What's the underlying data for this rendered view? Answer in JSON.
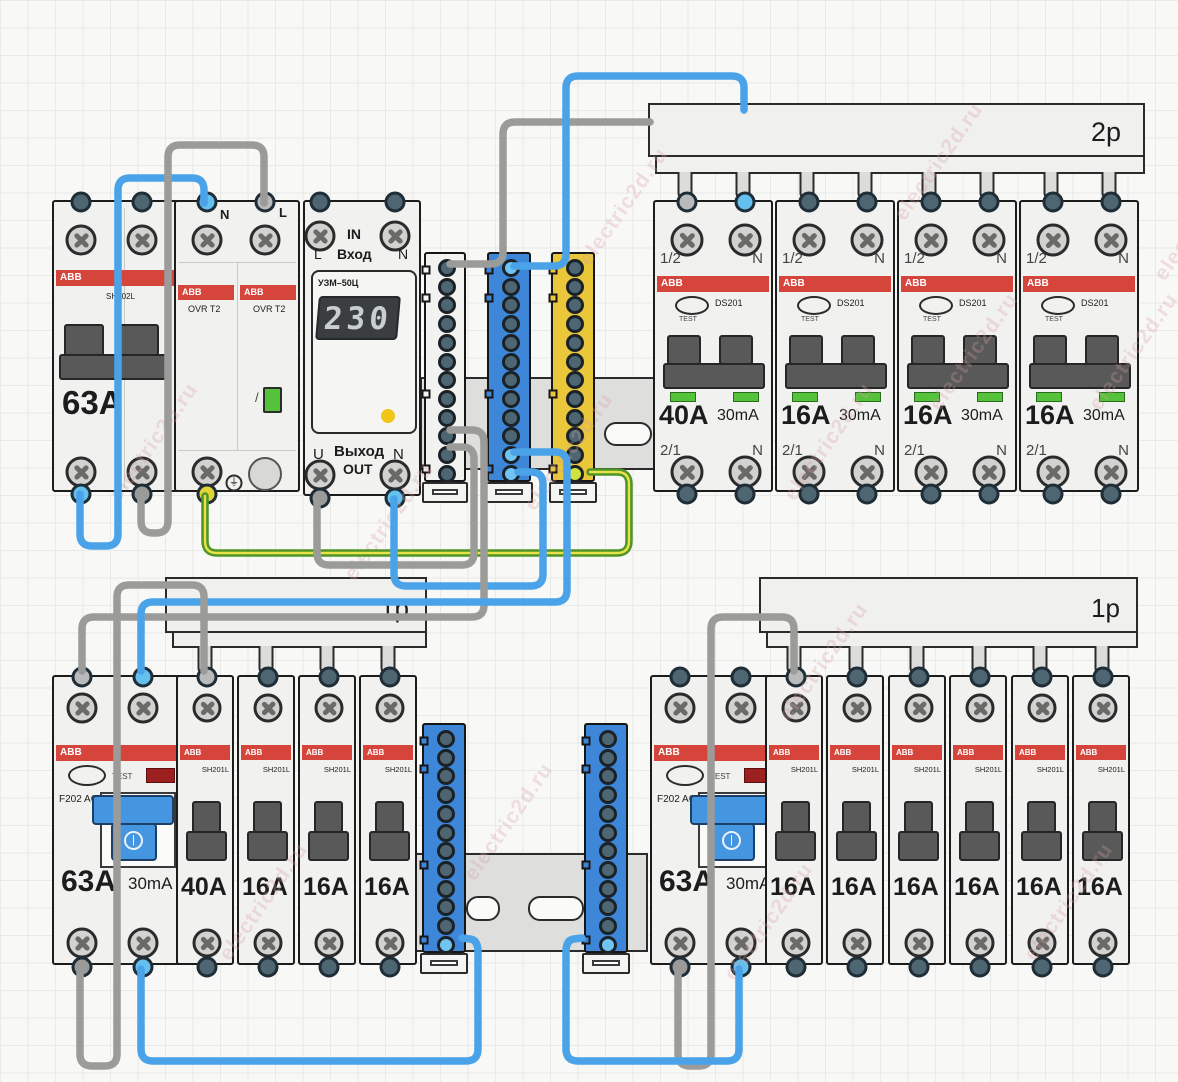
{
  "canvas": {
    "width": 1178,
    "height": 1082,
    "background": "#f8f8f6",
    "grid_color": "#e8eae8"
  },
  "watermark": {
    "text": "electric2d.ru",
    "color": "rgba(216,158,158,0.30)",
    "positions": [
      [
        85,
        430
      ],
      [
        320,
        510
      ],
      [
        500,
        440
      ],
      [
        555,
        195
      ],
      [
        760,
        430
      ],
      [
        905,
        340
      ],
      [
        1065,
        340
      ],
      [
        1130,
        210
      ],
      [
        195,
        890
      ],
      [
        440,
        810
      ],
      [
        700,
        910
      ],
      [
        1000,
        890
      ],
      [
        755,
        650
      ],
      [
        870,
        150
      ]
    ]
  },
  "colors": {
    "wire_blue": "#4aa3e8",
    "wire_gray": "#9b9b99",
    "wire_green": "#4e9426",
    "wire_green_stripe": "#e8e14a",
    "abb_red": "#d6453c",
    "cap_slate": "#4e6672",
    "cap_light_blue": "#63c0ef",
    "cap_light_gray": "#b9babb",
    "cap_gray": "#9a9a98",
    "cap_yellow": "#e3d438",
    "cap_pe_green": "#cfe23e",
    "busbar_blue": "#3e86d8",
    "busbar_yellow": "#e9c63a",
    "busbar_white": "#f2f2f0",
    "indicator_green": "#55c23c",
    "rcd_handle_blue": "#4596e0"
  },
  "top_row": {
    "sh202l": {
      "brand": "ABB",
      "model": "SH202L",
      "rating": "63A"
    },
    "ovr": {
      "n_label": "N",
      "l_label": "L",
      "left": {
        "brand": "ABB",
        "model": "OVR T2"
      },
      "right": {
        "brand": "ABB",
        "model": "OVR T2"
      },
      "earth_symbol": "⏚"
    },
    "uzm": {
      "model": "УЗМ–50Ц",
      "in_word": "IN",
      "in_ru": "Вход",
      "in_l": "L",
      "in_n": "N",
      "display": "230",
      "out_u": "U",
      "out_ru": "Выход",
      "out_word": "OUT",
      "out_n": "N"
    },
    "comb_2p_label": "2p",
    "ds201": [
      {
        "brand": "ABB",
        "model": "DS201",
        "test": "TEST",
        "t1": "1/2",
        "t2": "N",
        "b1": "2/1",
        "b2": "N",
        "rating": "40A",
        "diff": "30mA"
      },
      {
        "brand": "ABB",
        "model": "DS201",
        "test": "TEST",
        "t1": "1/2",
        "t2": "N",
        "b1": "2/1",
        "b2": "N",
        "rating": "16A",
        "diff": "30mA"
      },
      {
        "brand": "ABB",
        "model": "DS201",
        "test": "TEST",
        "t1": "1/2",
        "t2": "N",
        "b1": "2/1",
        "b2": "N",
        "rating": "16A",
        "diff": "30mA"
      },
      {
        "brand": "ABB",
        "model": "DS201",
        "test": "TEST",
        "t1": "1/2",
        "t2": "N",
        "b1": "2/1",
        "b2": "N",
        "rating": "16A",
        "diff": "30mA"
      }
    ]
  },
  "bottom_row": {
    "comb_1p_left_label": "1p",
    "comb_1p_right_label": "1p",
    "rcd_left": {
      "brand": "ABB",
      "model": "F202 AC",
      "test": "TEST",
      "rating": "63A",
      "diff": "30mA"
    },
    "rcd_right": {
      "brand": "ABB",
      "model": "F202 AC",
      "test": "TEST",
      "rating": "63A",
      "diff": "30mA"
    },
    "breakers_left": [
      {
        "brand": "ABB",
        "model": "SH201L",
        "rating": "40A"
      },
      {
        "brand": "ABB",
        "model": "SH201L",
        "rating": "16A"
      },
      {
        "brand": "ABB",
        "model": "SH201L",
        "rating": "16A"
      },
      {
        "brand": "ABB",
        "model": "SH201L",
        "rating": "16A"
      }
    ],
    "breakers_right": [
      {
        "brand": "ABB",
        "model": "SH201L",
        "rating": "16A"
      },
      {
        "brand": "ABB",
        "model": "SH201L",
        "rating": "16A"
      },
      {
        "brand": "ABB",
        "model": "SH201L",
        "rating": "16A"
      },
      {
        "brand": "ABB",
        "model": "SH201L",
        "rating": "16A"
      },
      {
        "brand": "ABB",
        "model": "SH201L",
        "rating": "16A"
      },
      {
        "brand": "ABB",
        "model": "SH201L",
        "rating": "16A"
      }
    ]
  },
  "busbars": {
    "top_white": {
      "kind": "terminal-strip",
      "color": "#f2f2f0",
      "terminals": 12,
      "specials": {}
    },
    "top_blue": {
      "kind": "neutral-busbar",
      "color": "#3e86d8",
      "terminals": 12,
      "specials": {
        "0": "blue",
        "10": "blue",
        "11": "blue"
      }
    },
    "top_yellow": {
      "kind": "pe-busbar",
      "color": "#e9c63a",
      "terminals": 12,
      "specials": {
        "11": "pe"
      }
    },
    "bottom_blue_left": {
      "kind": "neutral-busbar",
      "color": "#3e86d8",
      "terminals": 12,
      "specials": {
        "11": "blue"
      }
    },
    "bottom_blue_right": {
      "kind": "neutral-busbar",
      "color": "#3e86d8",
      "terminals": 12,
      "specials": {
        "11": "blue"
      }
    }
  },
  "wires": [
    {
      "name": "wire-n-sh202l-to-ovr",
      "color": "#4aa3e8",
      "points": [
        [
          80,
          494
        ],
        [
          80,
          546
        ],
        [
          118,
          546
        ],
        [
          118,
          178
        ],
        [
          204,
          178
        ],
        [
          204,
          203
        ]
      ]
    },
    {
      "name": "wire-l-sh202l-to-ovr",
      "color": "#9b9b99",
      "points": [
        [
          141,
          494
        ],
        [
          141,
          533
        ],
        [
          168,
          533
        ],
        [
          168,
          145
        ],
        [
          264,
          145
        ],
        [
          264,
          203
        ]
      ]
    },
    {
      "name": "wire-pe-ovr-to-yellow-busbar",
      "color": "#4e9426",
      "stripe": "#e8e14a",
      "points": [
        [
          205,
          496
        ],
        [
          205,
          553
        ],
        [
          629,
          553
        ],
        [
          629,
          472
        ],
        [
          590,
          472
        ]
      ]
    },
    {
      "name": "wire-l-uzm-to-white-strip",
      "color": "#9b9b99",
      "points": [
        [
          317,
          499
        ],
        [
          317,
          565
        ],
        [
          474,
          565
        ],
        [
          474,
          447
        ],
        [
          450,
          447
        ]
      ]
    },
    {
      "name": "wire-n-uzm-to-blue-busbar",
      "color": "#4aa3e8",
      "points": [
        [
          394,
          499
        ],
        [
          394,
          586
        ],
        [
          543,
          586
        ],
        [
          543,
          472
        ],
        [
          518,
          472
        ]
      ]
    },
    {
      "name": "wire-l-white-strip-to-comb2p",
      "color": "#9b9b99",
      "points": [
        [
          450,
          264
        ],
        [
          503,
          264
        ],
        [
          503,
          122
        ],
        [
          650,
          122
        ]
      ]
    },
    {
      "name": "wire-n-blue-busbar-to-comb2p",
      "color": "#4aa3e8",
      "points": [
        [
          514,
          266
        ],
        [
          566,
          266
        ],
        [
          566,
          76
        ],
        [
          744,
          76
        ],
        [
          744,
          110
        ]
      ]
    },
    {
      "name": "wire-l-white-strip-to-rcd-left",
      "color": "#9b9b99",
      "points": [
        [
          450,
          430
        ],
        [
          484,
          430
        ],
        [
          484,
          617
        ],
        [
          82,
          617
        ],
        [
          82,
          671
        ]
      ]
    },
    {
      "name": "wire-n-blue-busbar-to-rcd-left",
      "color": "#4aa3e8",
      "points": [
        [
          514,
          452
        ],
        [
          567,
          452
        ],
        [
          567,
          602
        ],
        [
          141,
          602
        ],
        [
          141,
          671
        ]
      ]
    },
    {
      "name": "wire-l-rcd-left-to-comb1p",
      "color": "#9b9b99",
      "points": [
        [
          80,
          969
        ],
        [
          80,
          1066
        ],
        [
          117,
          1066
        ],
        [
          117,
          585
        ],
        [
          204,
          585
        ],
        [
          204,
          671
        ]
      ]
    },
    {
      "name": "wire-n-rcd-left-to-bottom-busbar",
      "color": "#4aa3e8",
      "points": [
        [
          141,
          969
        ],
        [
          141,
          1061
        ],
        [
          478,
          1061
        ],
        [
          478,
          940
        ],
        [
          462,
          938
        ]
      ]
    },
    {
      "name": "wire-l-rcd-right-to-comb1p",
      "color": "#9b9b99",
      "points": [
        [
          678,
          969
        ],
        [
          678,
          1066
        ],
        [
          711,
          1066
        ],
        [
          711,
          617
        ],
        [
          794,
          617
        ],
        [
          794,
          671
        ]
      ]
    },
    {
      "name": "wire-n-rcd-right-to-bottom-busbar",
      "color": "#4aa3e8",
      "points": [
        [
          739,
          969
        ],
        [
          739,
          1061
        ],
        [
          566,
          1061
        ],
        [
          566,
          940
        ],
        [
          582,
          938
        ]
      ]
    }
  ]
}
